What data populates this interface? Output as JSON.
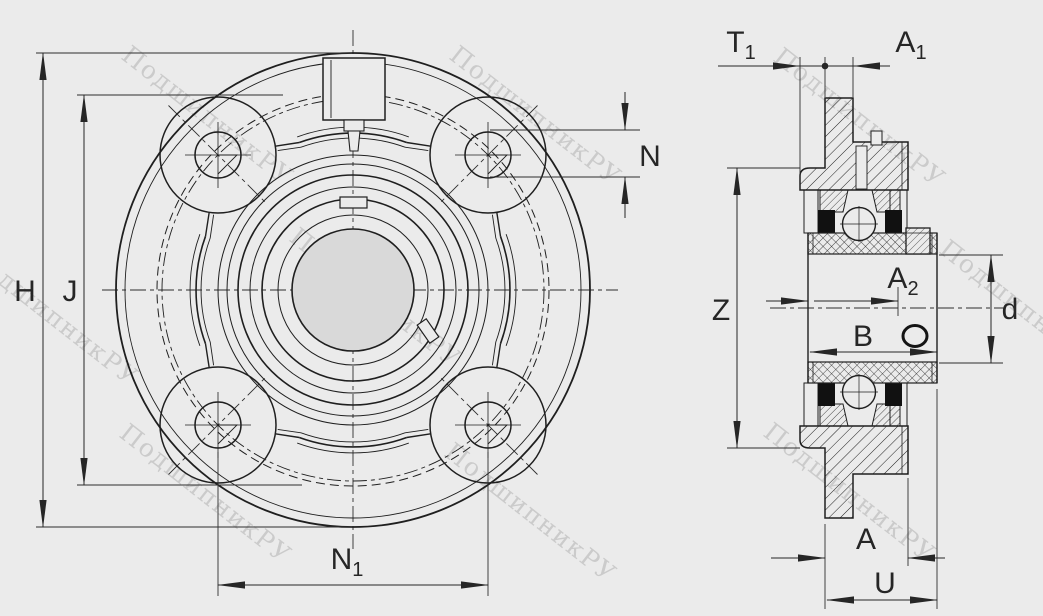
{
  "drawing": {
    "subject": "flanged cartridge bearing unit, 4-bolt round flange",
    "views": {
      "front": "front view with four bolt holes and grease fitting",
      "section": "axial cross-section with ball bearing, sleeve and set screw"
    }
  },
  "watermark": {
    "text": "ПодшипникРУ"
  },
  "colors": {
    "background": "#ebebeb",
    "line": "#1f1f1f",
    "dimension": "#262626",
    "watermark": "#c6c6c6",
    "bore_fill": "#d9d9d9",
    "seal_fill": "#111111"
  },
  "labels": {
    "H": "H",
    "J": "J",
    "N": "N",
    "N1": {
      "main": "N",
      "sub": "1"
    },
    "T1": {
      "main": "T",
      "sub": "1"
    },
    "A1": {
      "main": "A",
      "sub": "1"
    },
    "A2": {
      "main": "A",
      "sub": "2"
    },
    "Z": "Z",
    "B": "B",
    "d": "d",
    "A": "A",
    "U": "U"
  }
}
